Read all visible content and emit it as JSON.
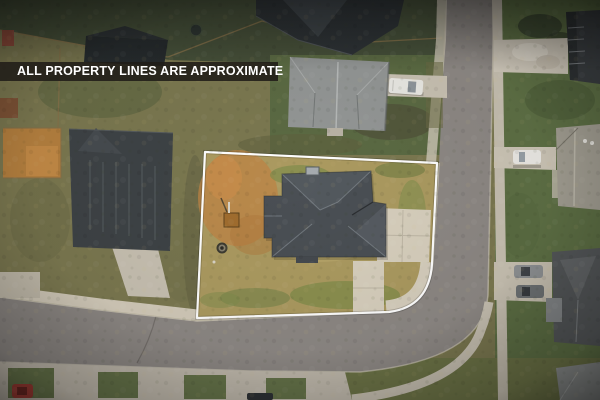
{
  "badge": {
    "text": "ALL PROPERTY LINES ARE APPROXIMATE",
    "background": "#201d18",
    "text_color": "#ffffff"
  },
  "scene": {
    "description": "Top-down aerial drone photo of a suburban corner lot outlined in white, with a gray-shingled house, driveway, curved road and neighboring homes",
    "featured_lot": {
      "boundary_shape": "corner lot with rounded street corner",
      "ground": "dead tan grass with orange dirt patches and green weeds",
      "objects": [
        "gray shingle roof house",
        "concrete driveway",
        "small wooden crate",
        "fire pit ring"
      ]
    },
    "vehicles": [
      "white pickup on upper driveway",
      "white car on right driveway",
      "two gray cars on lower right driveway",
      "red car bottom left",
      "dark car bottom center"
    ]
  },
  "colors": {
    "property_line": "#ffffff",
    "road_asphalt": "#8d8884",
    "sidewalk_concrete": "#d2cab9",
    "lot_grass": "#ab9a60",
    "dirt_orange": "#bd8344",
    "featured_roof": "#4a4f54",
    "neighbor_lawn": "#5e7045",
    "dark_roof": "#2f3437",
    "light_roof": "#939695"
  }
}
